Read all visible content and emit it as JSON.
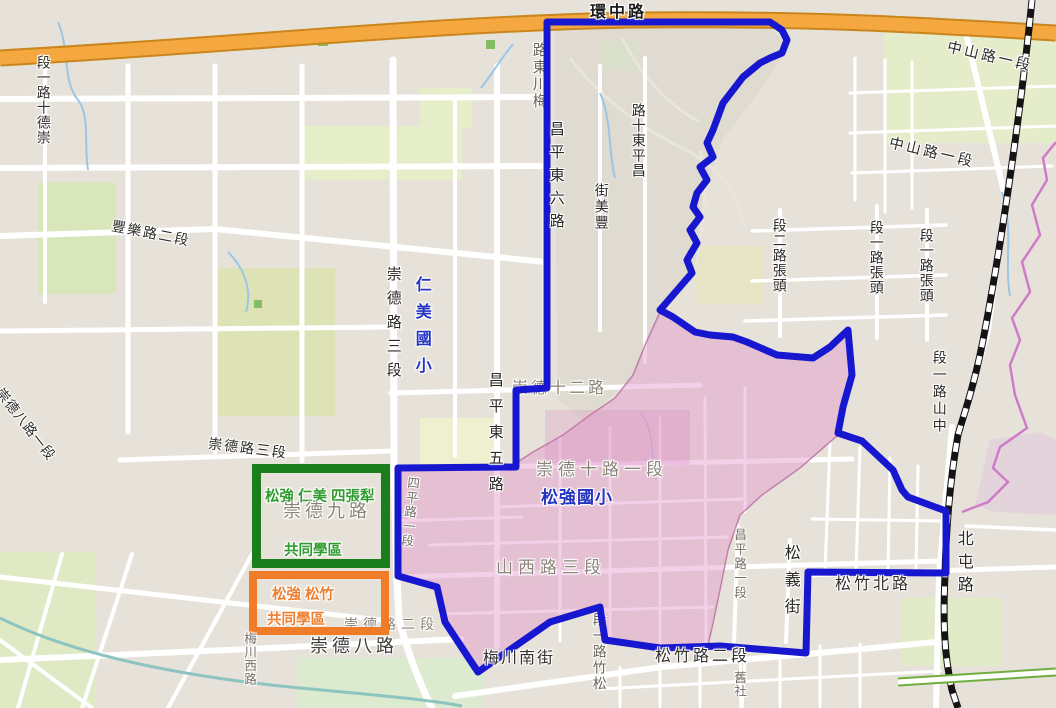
{
  "colors": {
    "district_boundary": "#1717d0",
    "school_zone_fill": "rgba(224,146,200,0.42)",
    "school_zone_edge": "rgba(186,108,160,0.8)",
    "ring_road": "#f5a840",
    "ring_road_casing": "#c9861c",
    "railway": "#141414",
    "boundary_purple": "#cf7bc8",
    "green_box_border": "#1c7d1c",
    "orange_box_border": "#f07c28",
    "green_box_text": "#2f9b2f",
    "orange_box_text": "#ef7f2f",
    "school_text": "#2334c0"
  },
  "legend_boxes": {
    "green": {
      "line1": "松強 仁美 四張犁",
      "line2": "共同學區"
    },
    "orange": {
      "line1": "松強 松竹",
      "line2": "共同學區"
    }
  },
  "road_labels": [
    {
      "text": "崇德十二路",
      "display": "崇德十二路",
      "kind": "road",
      "layer": "under",
      "x": 512,
      "y": 381,
      "fs": 16,
      "color": "#8a8378",
      "ls": 3
    },
    {
      "text": "崇德路二段",
      "display": "崇德路二段",
      "kind": "road",
      "layer": "under",
      "x": 344,
      "y": 617,
      "fs": 14,
      "color": "#8a8378",
      "ls": 5
    },
    {
      "text": "梅川東路",
      "display": "路東川梅",
      "kind": "road",
      "layer": "under",
      "x": 531,
      "y": 42,
      "fs": 15,
      "color": "#6b665c",
      "ls": 2,
      "v": true
    },
    {
      "text": "四平路一段",
      "display": "四平路一段",
      "kind": "road",
      "layer": "under",
      "x": 402,
      "y": 476,
      "fs": 12.5,
      "color": "#736e64",
      "ls": 2,
      "v": true,
      "rot": 6
    },
    {
      "text": "松竹路一段",
      "display": "段一路竹松",
      "kind": "road",
      "layer": "under",
      "x": 592,
      "y": 612,
      "fs": 14,
      "color": "#6b665c",
      "ls": 2,
      "v": true
    },
    {
      "text": "環中路",
      "display": "環中路",
      "kind": "road",
      "x": 590,
      "y": 5,
      "fs": 16,
      "color": "#1c1c1c",
      "ls": 3,
      "bold": true
    },
    {
      "text": "中山路一段",
      "display": "中山路一段",
      "kind": "road",
      "x": 946,
      "y": 50,
      "fs": 14.5,
      "color": "#2b2b28",
      "ls": 3,
      "rot": 13
    },
    {
      "text": "中山路一段",
      "display": "中山路一段",
      "kind": "road",
      "x": 888,
      "y": 146,
      "fs": 14.5,
      "color": "#2b2b28",
      "ls": 3,
      "rot": 13
    },
    {
      "text": "豐樂路二段",
      "display": "豐樂路二段",
      "kind": "road",
      "x": 111,
      "y": 226,
      "fs": 14,
      "color": "#2b2b28",
      "ls": 2,
      "rot": 11
    },
    {
      "text": "崇德路三段",
      "display": "崇德路三段",
      "kind": "road",
      "x": 208,
      "y": 441,
      "fs": 14,
      "color": "#2b2b28",
      "ls": 2,
      "rot": 7
    },
    {
      "text": "崇德八路一段",
      "display": "崇德八路一段",
      "kind": "road",
      "x": 4,
      "y": 386,
      "fs": 13.5,
      "color": "#2b2b28",
      "ls": 1,
      "rot": 52,
      "origin": "0 0"
    },
    {
      "text": "崇德十路一段",
      "display": "崇德十路一段",
      "kind": "road",
      "x": 536,
      "y": 461,
      "fs": 17,
      "color": "#8a8378",
      "ls": 5
    },
    {
      "text": "山西路三段",
      "display": "山西路三段",
      "kind": "road",
      "x": 496,
      "y": 559,
      "fs": 17,
      "color": "#8a8378",
      "ls": 5
    },
    {
      "text": "崇德九路",
      "display": "崇德九路",
      "kind": "road",
      "x": 283,
      "y": 502,
      "fs": 18,
      "color": "#8a8378",
      "ls": 4
    },
    {
      "text": "崇德八路",
      "display": "崇德八路",
      "kind": "road",
      "x": 310,
      "y": 637,
      "fs": 18,
      "color": "#3f3d3a",
      "ls": 4
    },
    {
      "text": "梅川南街",
      "display": "梅川南街",
      "kind": "road",
      "x": 483,
      "y": 651,
      "fs": 16,
      "color": "#33312e",
      "ls": 2
    },
    {
      "text": "松竹路二段",
      "display": "松竹路二段",
      "kind": "road",
      "x": 655,
      "y": 649,
      "fs": 16,
      "color": "#33312e",
      "ls": 3
    },
    {
      "text": "松竹北路",
      "display": "松竹北路",
      "kind": "road",
      "x": 835,
      "y": 577,
      "fs": 16,
      "color": "#33312e",
      "ls": 3
    },
    {
      "text": "松強國小",
      "display": "松強國小",
      "kind": "school",
      "x": 541,
      "y": 489,
      "fs": 17,
      "color": "#2334c0",
      "ls": 1,
      "bold": true
    },
    {
      "text": "仁美國小",
      "display": "仁美國小",
      "kind": "school",
      "x": 412,
      "y": 276,
      "fs": 16,
      "color": "#2334c0",
      "ls": 11,
      "bold": true,
      "v": true
    },
    {
      "text": "崇德十路一段",
      "display": "段一路十德崇",
      "kind": "road",
      "x": 36,
      "y": 55,
      "fs": 14,
      "color": "#33312e",
      "ls": 1,
      "v": true
    },
    {
      "text": "昌平東六路",
      "display": "昌平東六路",
      "kind": "road",
      "x": 548,
      "y": 121,
      "fs": 15,
      "color": "#2b2a27",
      "ls": 8,
      "v": true
    },
    {
      "text": "豐美街",
      "display": "街美豐",
      "kind": "road",
      "x": 594,
      "y": 183,
      "fs": 14,
      "color": "#2b2a27",
      "ls": 2,
      "v": true
    },
    {
      "text": "昌平東十路",
      "display": "路十東平昌",
      "kind": "road",
      "x": 631,
      "y": 103,
      "fs": 14,
      "color": "#2b2a27",
      "ls": 1,
      "v": true
    },
    {
      "text": "頭張路二段",
      "display": "段二路張頭",
      "kind": "road",
      "x": 772,
      "y": 218,
      "fs": 14,
      "color": "#2b2a27",
      "ls": 1,
      "v": true
    },
    {
      "text": "頭張路一段",
      "display": "段一路張頭",
      "kind": "road",
      "x": 869,
      "y": 220,
      "fs": 14,
      "color": "#2b2a27",
      "ls": 1,
      "v": true
    },
    {
      "text": "頭張路一段",
      "display": "段一路張頭",
      "kind": "road",
      "x": 919,
      "y": 228,
      "fs": 14,
      "color": "#2b2a27",
      "ls": 1,
      "v": true
    },
    {
      "text": "中山路一段",
      "display": "段一路山中",
      "kind": "road",
      "x": 932,
      "y": 350,
      "fs": 14,
      "color": "#2b2a27",
      "ls": 3,
      "v": true
    },
    {
      "text": "崇德路三段",
      "display": "崇德路三段",
      "kind": "road",
      "x": 385,
      "y": 266,
      "fs": 15,
      "color": "#2b2a27",
      "ls": 9,
      "v": true
    },
    {
      "text": "昌平東五路",
      "display": "昌平東五路",
      "kind": "road",
      "x": 487,
      "y": 372,
      "fs": 15,
      "color": "#2b2a27",
      "ls": 11,
      "v": true
    },
    {
      "text": "昌平路一段",
      "display": "昌平路一段",
      "kind": "road",
      "x": 732,
      "y": 528,
      "fs": 12.5,
      "color": "#736e64",
      "ls": 2,
      "v": true
    },
    {
      "text": "北屯路",
      "display": "北屯路",
      "kind": "road",
      "x": 954,
      "y": 530,
      "fs": 16,
      "color": "#2b2a27",
      "ls": 7,
      "v": true
    },
    {
      "text": "松義街",
      "display": "松義街",
      "kind": "road",
      "x": 781,
      "y": 544,
      "fs": 16,
      "color": "#2b2a27",
      "ls": 11,
      "v": true
    },
    {
      "text": "梅川西路",
      "display": "梅川西路",
      "kind": "road",
      "x": 242,
      "y": 632,
      "fs": 12.5,
      "color": "#736e64",
      "ls": 1,
      "v": true
    },
    {
      "text": "舊社",
      "display": "舊社",
      "kind": "road",
      "x": 732,
      "y": 671,
      "fs": 12.5,
      "color": "#736e64",
      "ls": 1,
      "v": true
    }
  ]
}
